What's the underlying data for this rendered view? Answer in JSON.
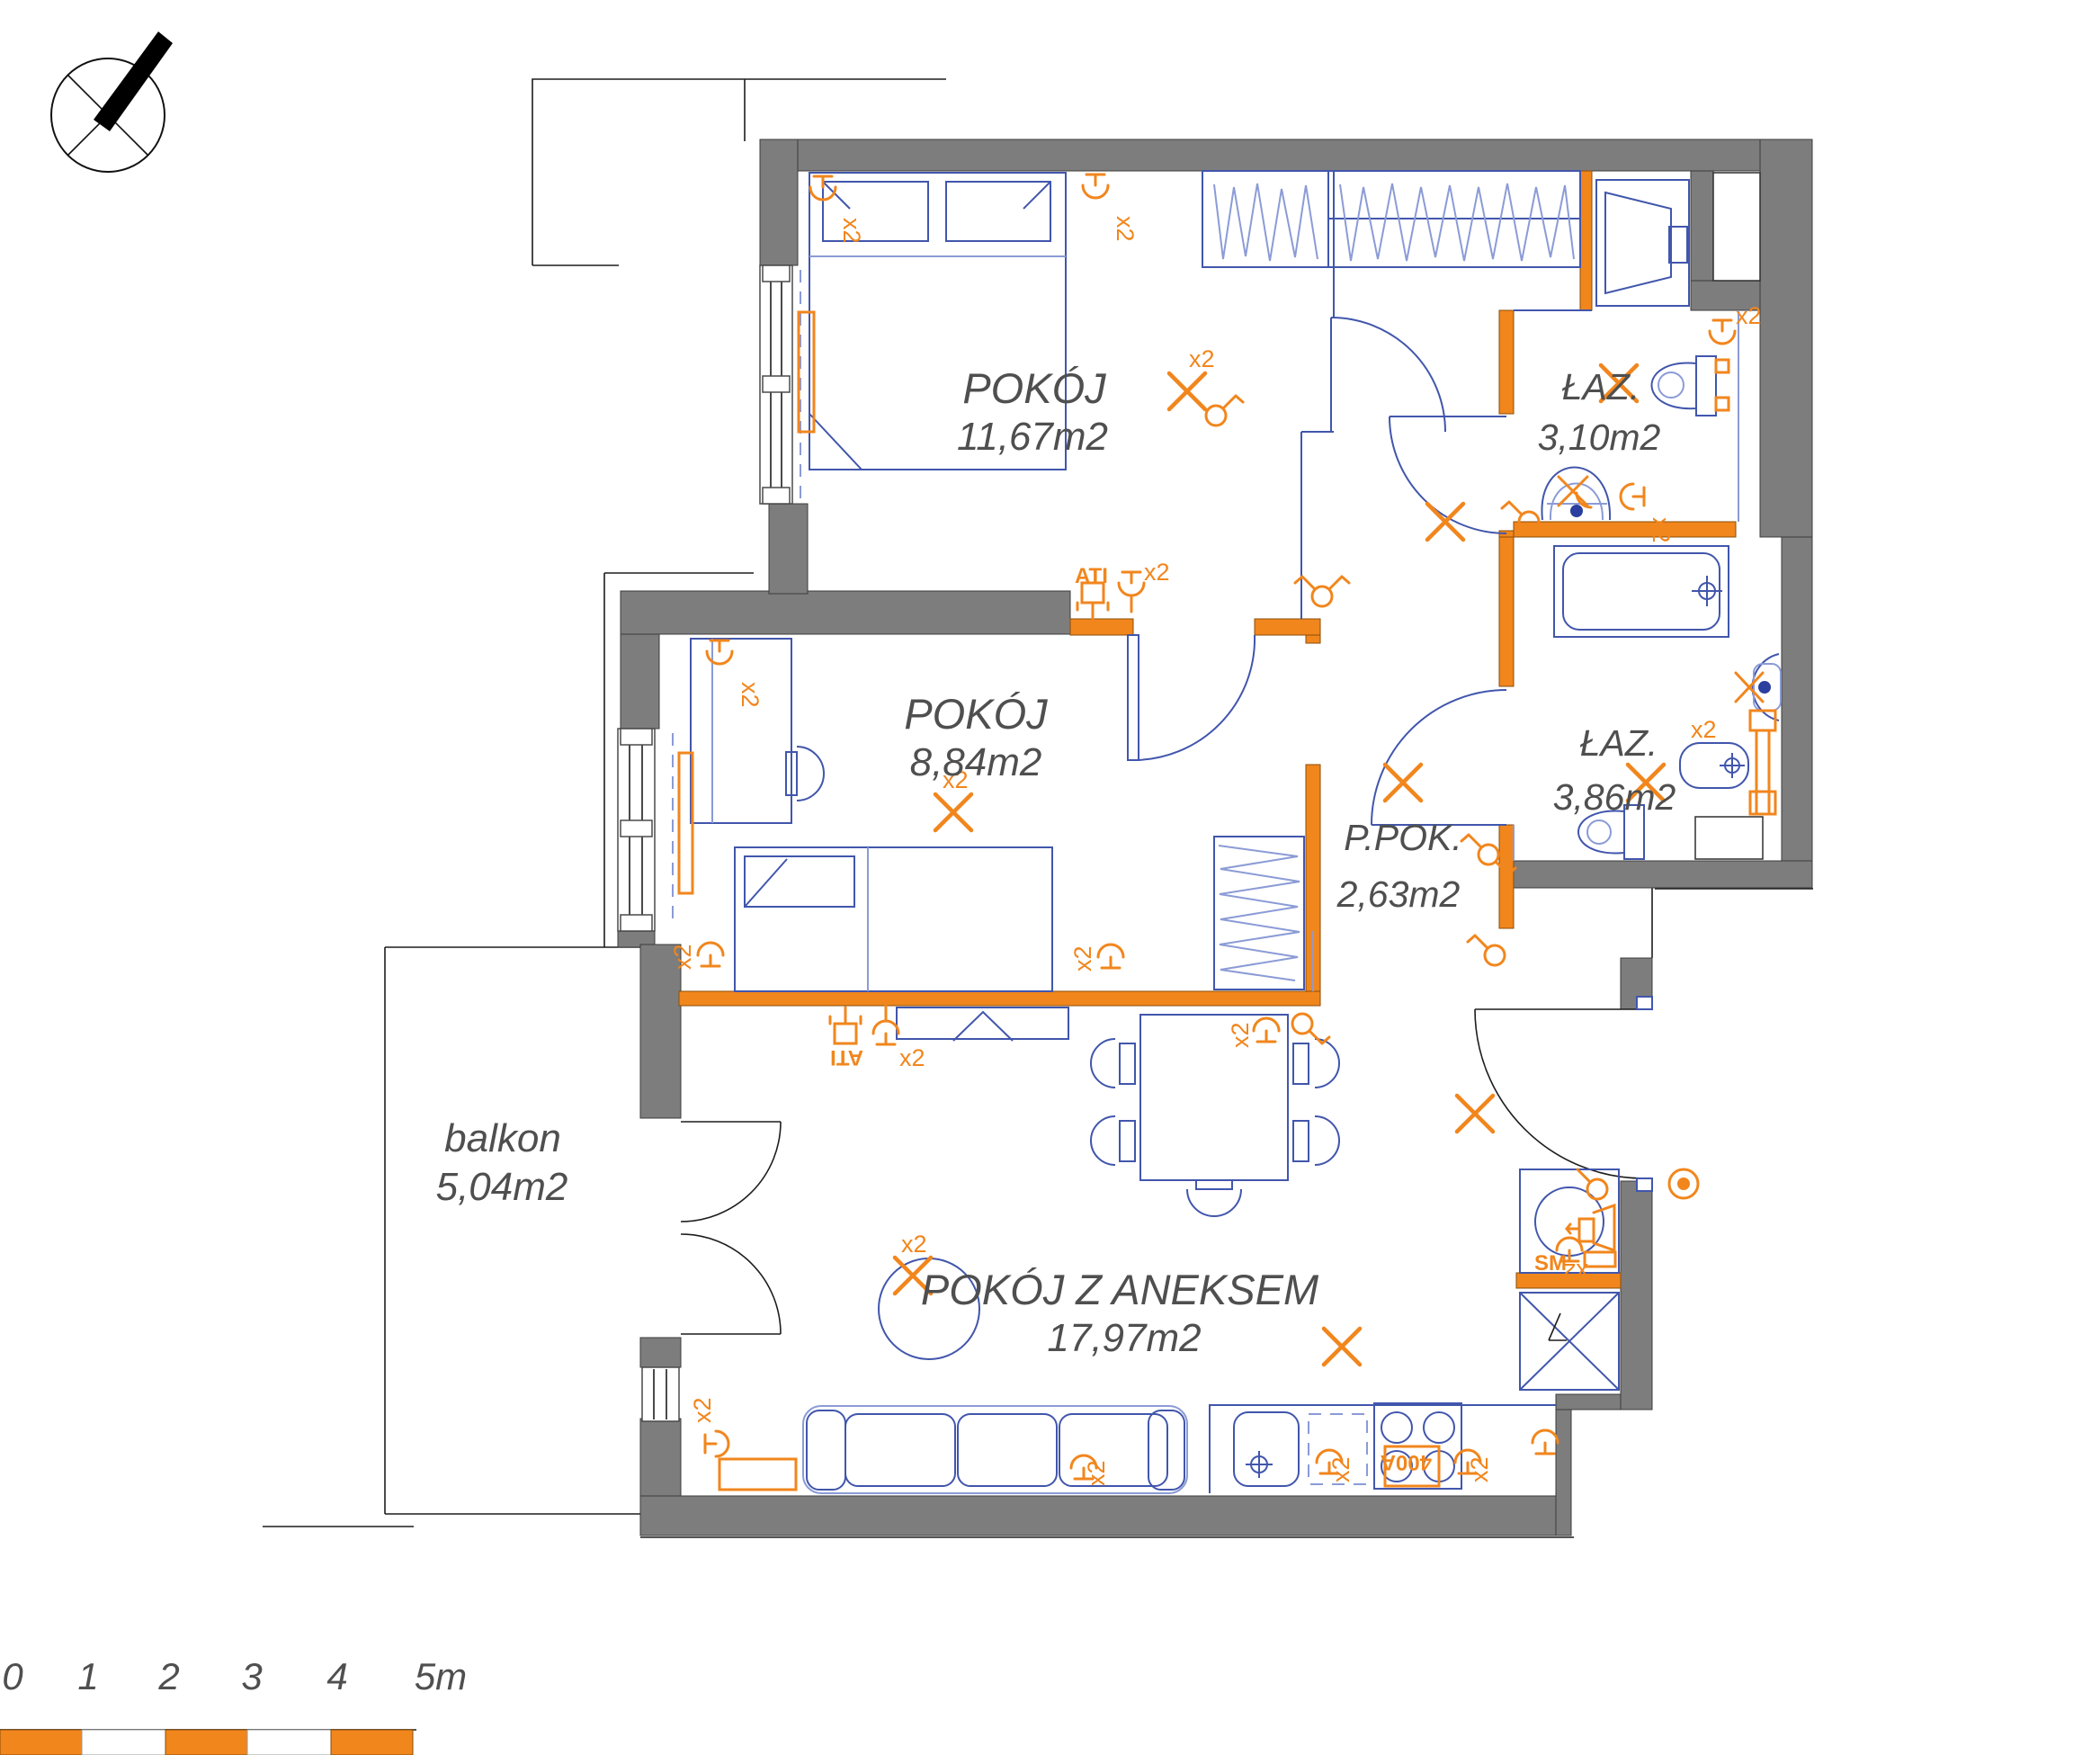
{
  "rooms": [
    {
      "id": "room1",
      "name": "POKÓJ",
      "area": "11,67m2"
    },
    {
      "id": "room2",
      "name": "POKÓJ",
      "area": "8,84m2"
    },
    {
      "id": "hall",
      "name": "P.POK.",
      "area": "2,63m2"
    },
    {
      "id": "bath1",
      "name": "ŁAZ.",
      "area": "3,10m2"
    },
    {
      "id": "bath2",
      "name": "ŁAZ.",
      "area": "3,86m2"
    },
    {
      "id": "living",
      "name": "POKÓJ Z ANEKSEM",
      "area": "17,97m2"
    },
    {
      "id": "balcony",
      "name": "balkon",
      "area": "5,04m2"
    }
  ],
  "symbols": {
    "x2": "x2",
    "ati": "ATI",
    "sm": "SM",
    "power": "400A"
  },
  "scale_bar": {
    "labels": [
      "0",
      "1",
      "2",
      "3",
      "4",
      "5m"
    ]
  },
  "colors": {
    "wall": "#7d7d7d",
    "partition": "#f1861d",
    "furniture": "#4156ac",
    "accent": "#f1861d"
  }
}
